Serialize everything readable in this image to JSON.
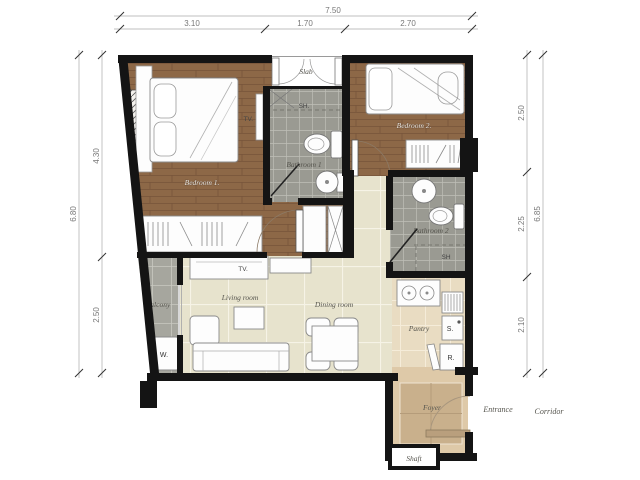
{
  "title": "Apartment unit floor plan",
  "dimensions": {
    "top_total": "7.50",
    "top_seg1": "3.10",
    "top_seg2": "1.70",
    "top_seg3": "2.70",
    "left_total": "6.80",
    "left_seg1": "4.30",
    "left_seg2": "2.50",
    "right_total": "6.85",
    "right_seg1": "2.50",
    "right_seg2": "2.25",
    "right_seg3": "2.10"
  },
  "rooms": {
    "bedroom1": "Bedroom 1.",
    "bedroom2": "Bedroom 2.",
    "bathroom1": "Bathroom 1",
    "bathroom2": "Bathroom 2",
    "living": "Living room",
    "dining": "Dining room",
    "balcony": "Balcony",
    "pantry": "Pantry",
    "foyer": "Foyer",
    "slab": "Slab",
    "shaft": "Shaft",
    "entrance": "Entrance",
    "corridor": "Corridor"
  },
  "fixtures": {
    "shower1": "SH.",
    "shower2": "SH",
    "tv_bedroom": "TV.",
    "tv_living": "TV.",
    "washer": "W.",
    "kitchen_sink": "S.",
    "fridge": "R."
  },
  "colors": {
    "wall": "#141414",
    "wood_floor": "#8d6847",
    "bath_tile": "#9a9a92",
    "living_floor": "#e7e3cd",
    "kitchen_floor": "#e9dcc2",
    "balcony_tile": "#a6a69e",
    "foyer_floor": "#dec9a8",
    "foyer_tile": "#c9b08c",
    "furniture": "#fdfdfd"
  }
}
